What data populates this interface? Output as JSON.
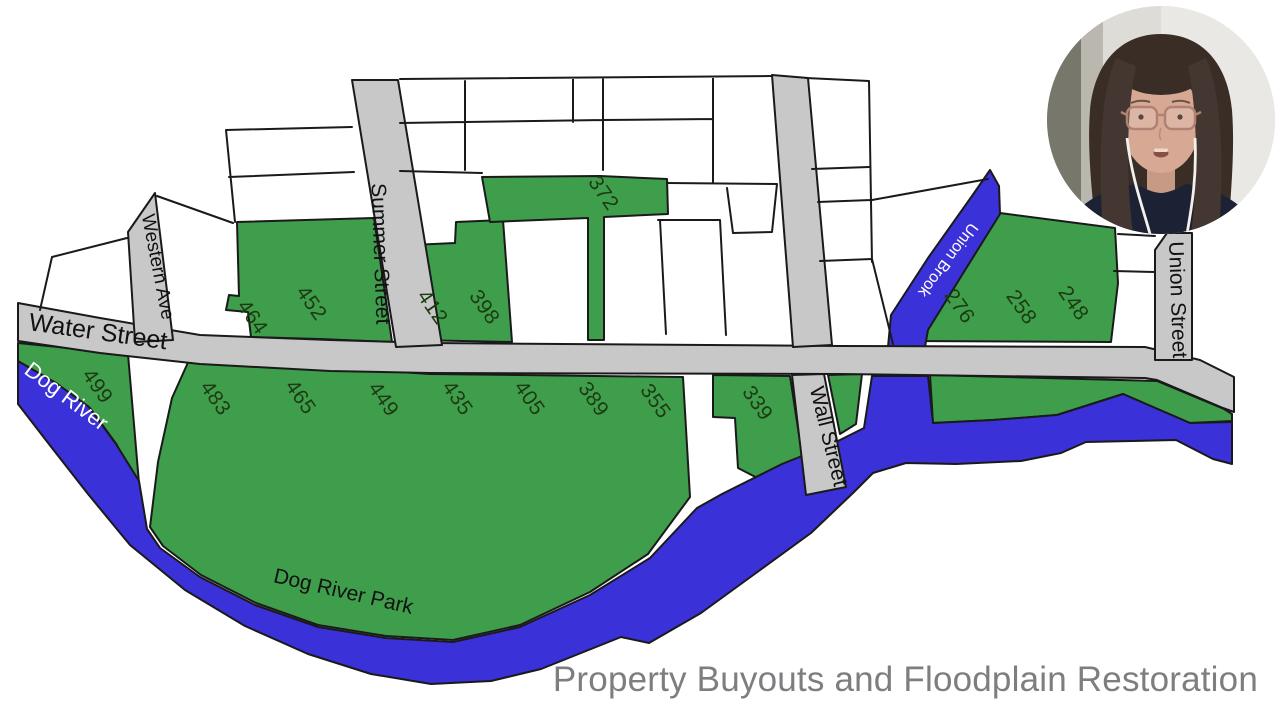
{
  "title": "Property Buyouts and Floodplain Restoration",
  "colors": {
    "parcel_green": "#3f9e4c",
    "water_blue": "#3a31d8",
    "street_gray": "#c8c8c8",
    "outline": "#1a1a1a",
    "number_green": "#1d3a12",
    "title_gray": "#7d7e80"
  },
  "map": {
    "streets": [
      {
        "id": "water-street",
        "label": "Water Street"
      },
      {
        "id": "western-ave",
        "label": "Western Ave"
      },
      {
        "id": "summer-street",
        "label": "Summer Street"
      },
      {
        "id": "wall-street",
        "label": "Wall Street"
      },
      {
        "id": "union-street",
        "label": "Union Street"
      }
    ],
    "waterways": [
      {
        "id": "dog-river",
        "label": "Dog River"
      },
      {
        "id": "union-brook",
        "label": "Union Brook"
      }
    ],
    "park_label": "Dog River Park",
    "parcel_numbers": [
      "499",
      "483",
      "465",
      "449",
      "435",
      "405",
      "389",
      "355",
      "339",
      "464",
      "452",
      "412",
      "398",
      "372",
      "276",
      "258",
      "248"
    ]
  }
}
